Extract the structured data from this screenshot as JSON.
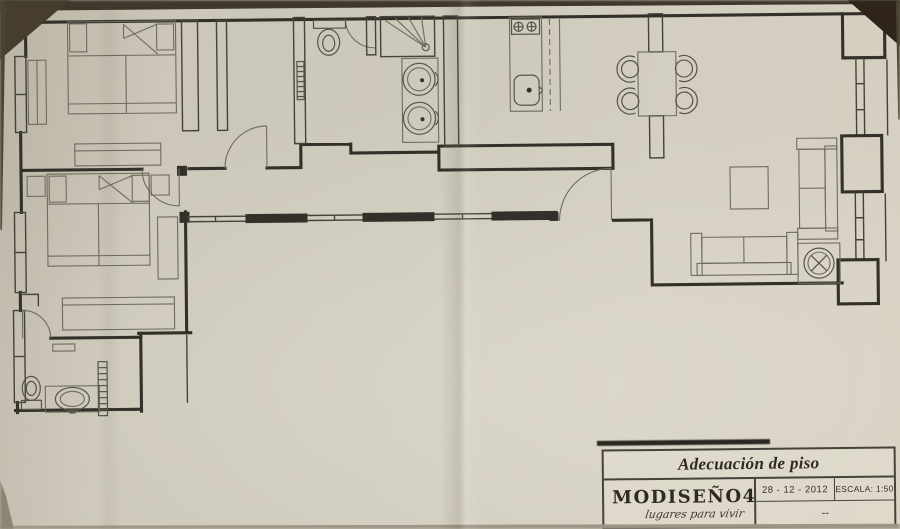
{
  "title_block": {
    "title": "Adecuación de piso",
    "company": "MODISEÑO4",
    "tagline": "lugares para vivir",
    "date": "28 - 12 - 2012",
    "scale": "ESCALA: 1:50",
    "revision": "--"
  },
  "colors": {
    "paper": "#cfc9bb",
    "ink": "#33302a",
    "photo_shadow": "#3b3226"
  }
}
